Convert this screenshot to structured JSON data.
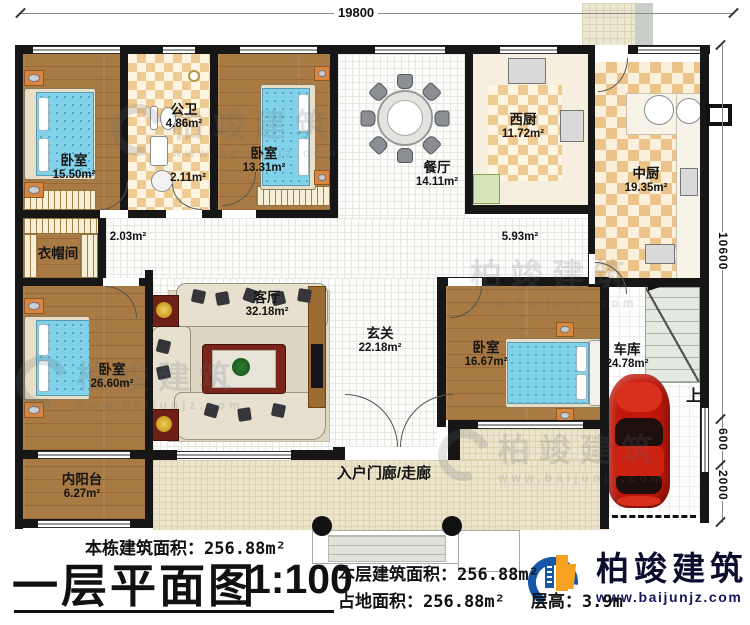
{
  "dimensions": {
    "top": "19800",
    "right_total": "10600",
    "right_step": "600",
    "right_porch": "2000"
  },
  "rooms": {
    "bedroom_tl": {
      "name": "卧室",
      "area": "15.50m²"
    },
    "bath": {
      "name": "公卫",
      "area": "4.86m²"
    },
    "shower_area": {
      "area": "2.11m²"
    },
    "bedroom_tm": {
      "name": "卧室",
      "area": "13.31m²"
    },
    "dining": {
      "name": "餐厅",
      "area": "14.11m²"
    },
    "west_kitchen": {
      "name": "西厨",
      "area": "11.72m²"
    },
    "mid_kitchen": {
      "name": "中厨",
      "area": "19.35m²"
    },
    "cloakroom": {
      "name": "衣帽间"
    },
    "hall_small": {
      "area": "2.03m²"
    },
    "hall_right": {
      "area": "5.93m²"
    },
    "living": {
      "name": "客厅",
      "area": "32.18m²"
    },
    "foyer": {
      "name": "玄关",
      "area": "22.18m²"
    },
    "bedroom_bl": {
      "name": "卧室",
      "area": "26.60m²"
    },
    "bedroom_br": {
      "name": "卧室",
      "area": "16.67m²"
    },
    "garage": {
      "name": "车库",
      "area": "24.78m²"
    },
    "balcony": {
      "name": "内阳台",
      "area": "6.27m²"
    },
    "porch": {
      "name": "入户门廊/走廊"
    }
  },
  "stairs": {
    "up_label": "上"
  },
  "summary": {
    "building_area_label": "本栋建筑面积：",
    "building_area_value": "256.88m²",
    "title": "一层平面图",
    "scale": "1:100",
    "floor_area_label": "本层建筑面积：",
    "floor_area_value": "256.88m²",
    "footprint_label": "占地面积：",
    "footprint_value": "256.88m²",
    "height_label": "层高：",
    "height_value": "3.9m"
  },
  "logo": {
    "name": "柏竣建筑",
    "website": "www.baijunjz.com"
  },
  "watermark": {
    "text": "柏竣建筑",
    "website": "www.baijunjz.com"
  },
  "colors": {
    "wall": "#161616",
    "wood_floor": "#a97a43",
    "kitchen_checker": "#eecb93",
    "bed_blue": "#82d2ea",
    "car_red": "#c2180b",
    "logo_blue": "#1558a8",
    "logo_orange": "#f6a11f"
  }
}
